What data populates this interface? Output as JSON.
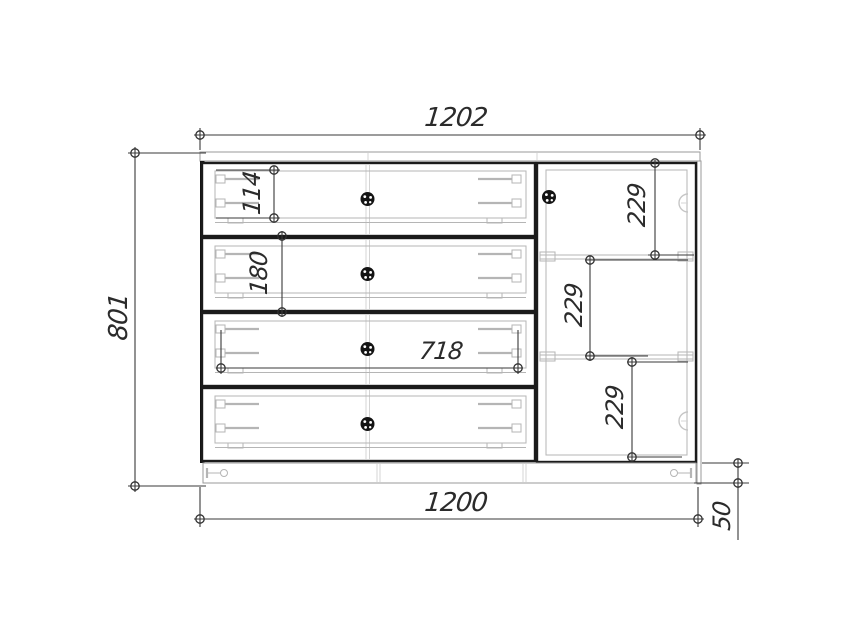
{
  "drawing": {
    "type": "furniture-technical-drawing",
    "colors": {
      "background": "#ffffff",
      "outline": "#1b1b1b",
      "hardware_detail": "#b5b5b5",
      "dimension": "#3a3a3a"
    },
    "dimensions": {
      "top_width": {
        "label": "1202"
      },
      "left_height": {
        "label": "801"
      },
      "drawer1_inner_height": {
        "label": "114"
      },
      "drawer2_front_height": {
        "label": "180"
      },
      "drawer_inner_width": {
        "label": "718"
      },
      "door_section_top": {
        "label": "229"
      },
      "door_section_middle": {
        "label": "229"
      },
      "door_section_bottom": {
        "label": "229"
      },
      "bottom_width": {
        "label": "1200"
      },
      "plinth_height": {
        "label": "50"
      }
    }
  }
}
